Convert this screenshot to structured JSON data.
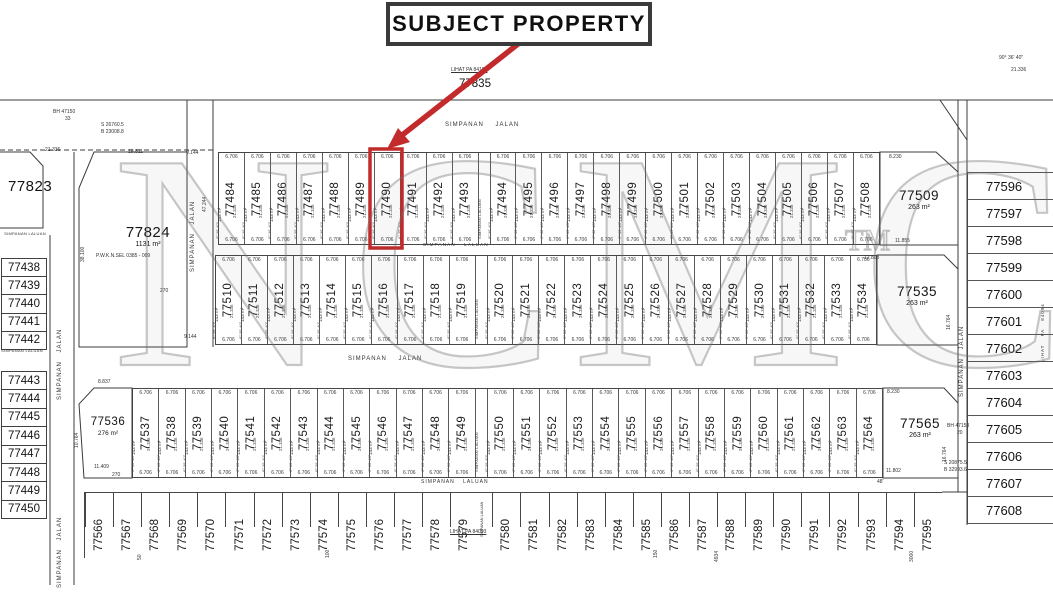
{
  "header": {
    "subject_label": "SUBJECT PROPERTY"
  },
  "highlight": {
    "lot": "77490",
    "color": "#c22a2b"
  },
  "watermark": {
    "text": "NCMCo",
    "tm": "TM"
  },
  "roads": {
    "jalan": "SIMPANAN JALAN",
    "laluan": "SIMPANAN LALUAN",
    "lihat_right": "LIHAT PA 84094"
  },
  "cell_annotations": {
    "width": "6.706",
    "depth": "21.336",
    "area": "143 m²",
    "bearing": "6° 35' 40\""
  },
  "named_lots": {
    "l77835": {
      "number": "77835"
    },
    "l77823": {
      "number": "77823"
    },
    "l77824": {
      "number": "77824",
      "area": "1131 m²"
    },
    "l77509": {
      "number": "77509",
      "area": "263 m²"
    },
    "l77535": {
      "number": "77535",
      "area": "263 m²"
    },
    "l77536": {
      "number": "77536",
      "area": "276 m²"
    },
    "l77565": {
      "number": "77565",
      "area": "263 m²"
    }
  },
  "rows": {
    "row1": [
      "77484",
      "77485",
      "77486",
      "77487",
      "77488",
      "77489",
      "77490",
      "77491",
      "77492",
      "77493",
      "@LANE",
      "77494",
      "77495",
      "77496",
      "77497",
      "77498",
      "77499",
      "77500",
      "77501",
      "77502",
      "77503",
      "77504",
      "77505",
      "77506",
      "77507",
      "77508"
    ],
    "row2": [
      "77510",
      "77511",
      "77512",
      "77513",
      "77514",
      "77515",
      "77516",
      "77517",
      "77518",
      "77519",
      "@LANE",
      "77520",
      "77521",
      "77522",
      "77523",
      "77524",
      "77525",
      "77526",
      "77527",
      "77528",
      "77529",
      "77530",
      "77531",
      "77532",
      "77533",
      "77534"
    ],
    "row3": [
      "77537",
      "77538",
      "77539",
      "77540",
      "77541",
      "77542",
      "77543",
      "77544",
      "77545",
      "77546",
      "77547",
      "77548",
      "77549",
      "@LANE",
      "77550",
      "77551",
      "77552",
      "77553",
      "77554",
      "77555",
      "77556",
      "77557",
      "77558",
      "77559",
      "77560",
      "77561",
      "77562",
      "77563",
      "77564"
    ],
    "bottom": [
      "77566",
      "77567",
      "77568",
      "77569",
      "77570",
      "77571",
      "77572",
      "77573",
      "77574",
      "77575",
      "77576",
      "77577",
      "77578",
      "77579",
      "@LANE",
      "77580",
      "77581",
      "77582",
      "77583",
      "77584",
      "77585",
      "77586",
      "77587",
      "77588",
      "77589",
      "77590",
      "77591",
      "77592",
      "77593",
      "77594",
      "77595"
    ]
  },
  "columns": {
    "left_a": [
      "77438",
      "77439",
      "77440",
      "77441",
      "77442"
    ],
    "left_b": [
      "77443",
      "77444",
      "77445",
      "77446",
      "77447",
      "77448",
      "77449",
      "77450"
    ],
    "right": [
      "77596",
      "77597",
      "77598",
      "77599",
      "77600",
      "77601",
      "77602",
      "77603",
      "77604",
      "77605",
      "77606",
      "77607",
      "77608"
    ]
  },
  "floating_texts": [
    "21.336",
    "19.811",
    "9.144",
    "47.244",
    "38.100",
    "270",
    "9.144",
    "270",
    "8.837",
    "11.409",
    "10.764",
    "8.230",
    "11.855",
    "12.803",
    "16.764",
    "8.230",
    "16.764",
    "11.802",
    "48'",
    "90° 36' 40\"",
    "21.336",
    "50",
    "100",
    "150",
    "4934",
    "3000",
    "P.W.K.N.SEL 0385 - 009",
    "S 26760.5",
    "B 23008.8",
    "BH 47150",
    "33",
    "BH 47153",
    "20",
    "S 20875.5",
    "B 32993.6",
    "LIHAT PA 84093",
    "LIHAT PA 84101"
  ]
}
